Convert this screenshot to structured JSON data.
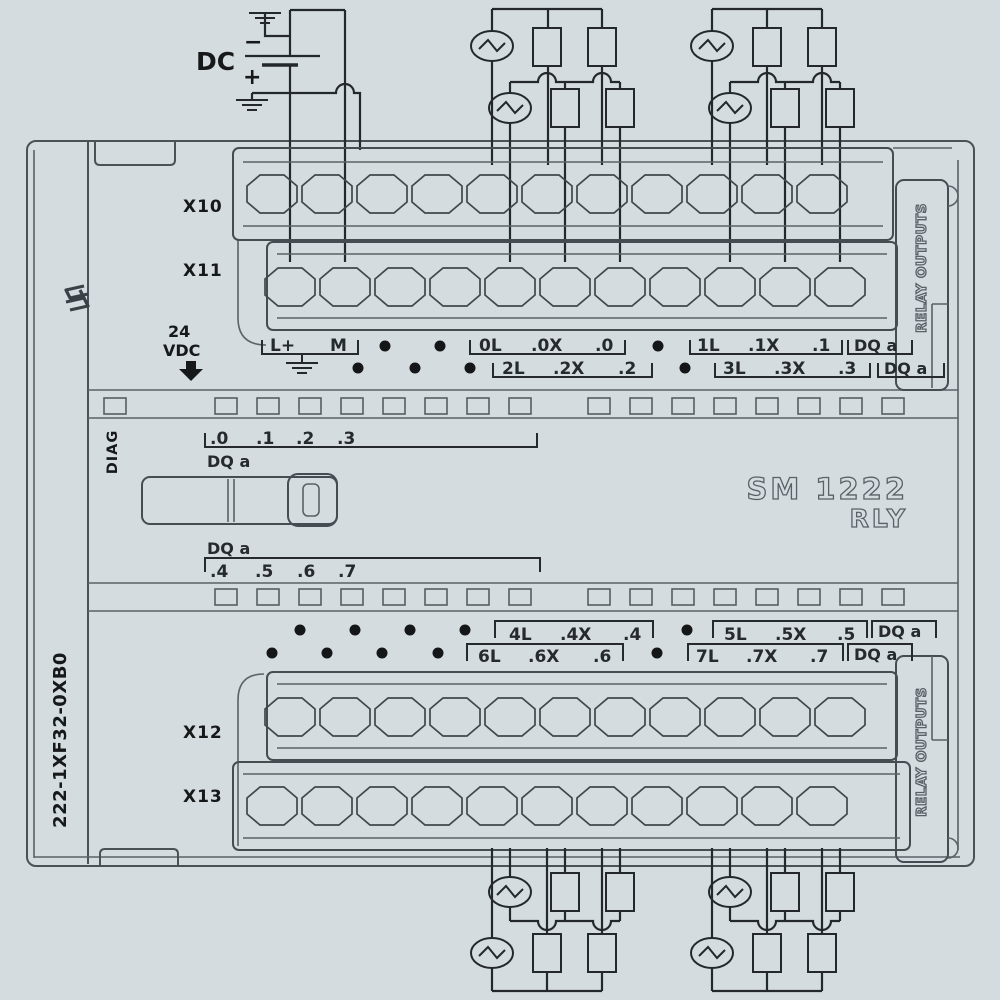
{
  "colors": {
    "background": "#d4dce0",
    "wire": "#24282c",
    "case_outline": "#4a5257",
    "text": "#26292d",
    "engraved": "#596167"
  },
  "power": {
    "dc": "DC",
    "minus": "−",
    "plus": "+",
    "voltage": [
      "24",
      "VDC"
    ]
  },
  "module": {
    "model": [
      "SM 1222",
      "RLY"
    ],
    "part_number": "222-1XF32-0XB0",
    "diag": "DIAG",
    "relay_outputs_top": "RELAY OUTPUTS",
    "relay_outputs_bottom": "RELAY OUTPUTS",
    "connector_x10": "X10",
    "connector_x11": "X11",
    "connector_x12": "X12",
    "connector_x13": "X13"
  },
  "terminal_labels": {
    "row1_group0": [
      "L+",
      "M"
    ],
    "row1_group1": [
      "0L",
      ".0X",
      ".0"
    ],
    "row1_group2": [
      "1L",
      ".1X",
      ".1"
    ],
    "row1_dq": "DQ a",
    "row2_group1": [
      "2L",
      ".2X",
      ".2"
    ],
    "row2_group2": [
      "3L",
      ".3X",
      ".3"
    ],
    "row2_dq": "DQ a",
    "mid_top_bits": [
      ".0",
      ".1",
      ".2",
      ".3"
    ],
    "mid_top_dq": "DQ a",
    "mid_bottom_dq": "DQ a",
    "mid_bottom_bits": [
      ".4",
      ".5",
      ".6",
      ".7"
    ],
    "row3_group1": [
      "4L",
      ".4X",
      ".4"
    ],
    "row3_group2": [
      "5L",
      ".5X",
      ".5"
    ],
    "row3_dq": "DQ a",
    "row4_group1": [
      "6L",
      ".6X",
      ".6"
    ],
    "row4_group2": [
      "7L",
      ".7X",
      ".7"
    ],
    "row4_dq": "DQ a"
  }
}
